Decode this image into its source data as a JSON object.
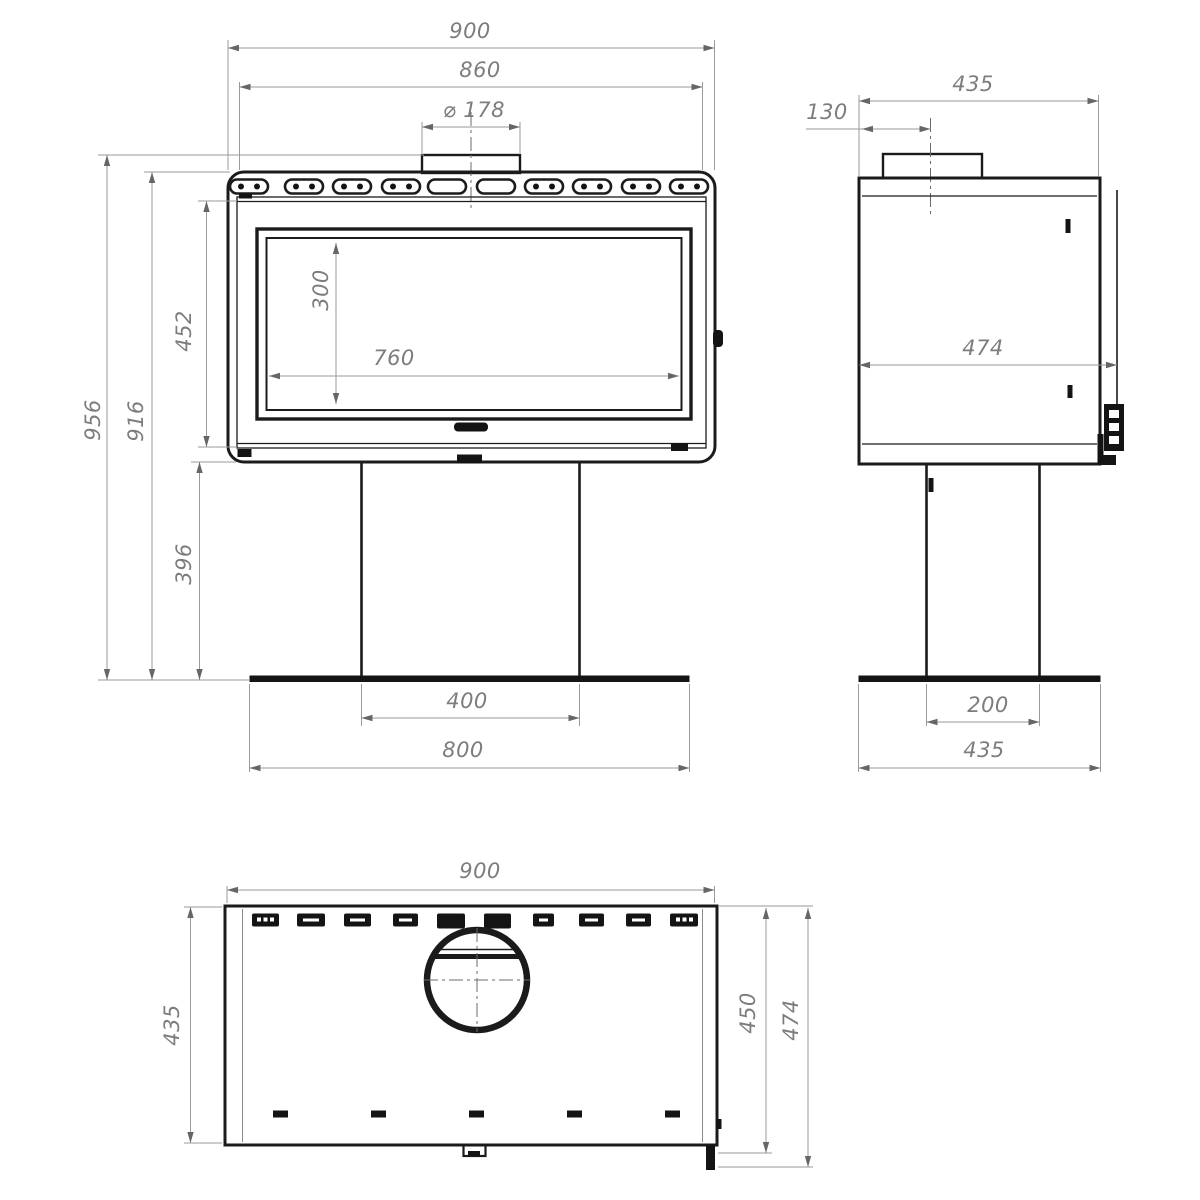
{
  "drawing": {
    "type": "fireplace-stove-dimension-drawing",
    "background_color": "#ffffff",
    "line_color": "#1b1b1b",
    "dimension_color": "#7d7d7d",
    "front_view": {
      "labels": {
        "overall_width": "900",
        "inner_width": "860",
        "flue_diameter": "⌀ 178",
        "glass_height": "300",
        "glass_width": "760",
        "overall_height": "956",
        "body_top_height": "916",
        "door_height": "452",
        "pedestal_height": "396",
        "pedestal_width": "400",
        "base_width": "800"
      }
    },
    "side_view": {
      "labels": {
        "overall_depth": "435",
        "flue_center_offset": "130",
        "depth_with_handle": "474",
        "pedestal_depth": "200",
        "base_depth": "435"
      }
    },
    "plan_view": {
      "labels": {
        "overall_width": "900",
        "body_depth": "435",
        "top_plate_depth": "450",
        "total_depth": "474"
      }
    }
  }
}
